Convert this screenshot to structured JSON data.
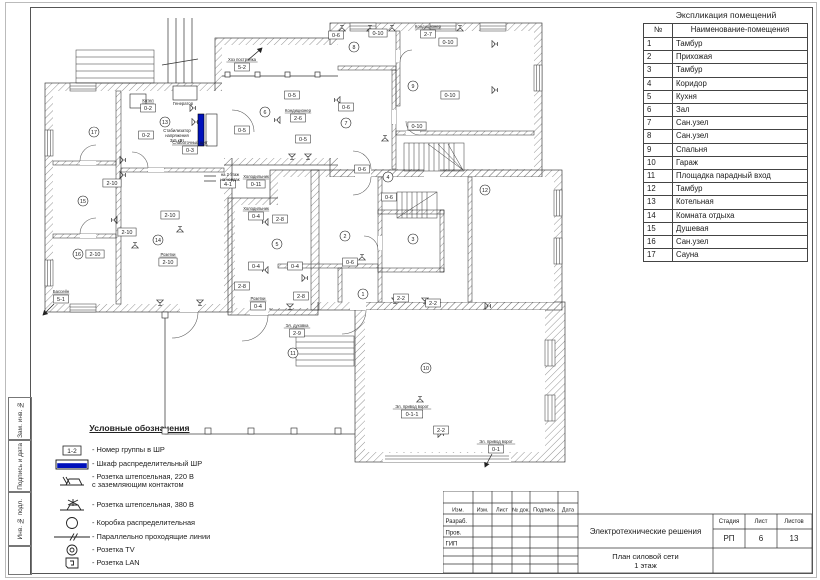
{
  "sheet": {
    "side_labels": [
      "Зам. инв. №",
      "Подпись и дата",
      "Инв. № подл."
    ]
  },
  "explication": {
    "title": "Экспликация помещений",
    "col_num": "№",
    "col_name": "Наименование-помещения",
    "rows": [
      {
        "n": "1",
        "name": "Тамбур"
      },
      {
        "n": "2",
        "name": "Прихожая"
      },
      {
        "n": "3",
        "name": "Тамбур"
      },
      {
        "n": "4",
        "name": "Коридор"
      },
      {
        "n": "5",
        "name": "Кухня"
      },
      {
        "n": "6",
        "name": "Зал"
      },
      {
        "n": "7",
        "name": "Сан.узел"
      },
      {
        "n": "8",
        "name": "Сан.узел"
      },
      {
        "n": "9",
        "name": "Спальня"
      },
      {
        "n": "10",
        "name": "Гараж"
      },
      {
        "n": "11",
        "name": "Площадка парадный вход"
      },
      {
        "n": "12",
        "name": "Тамбур"
      },
      {
        "n": "13",
        "name": "Котельная"
      },
      {
        "n": "14",
        "name": "Комната отдыха"
      },
      {
        "n": "15",
        "name": "Душевая"
      },
      {
        "n": "16",
        "name": "Сан.узел"
      },
      {
        "n": "17",
        "name": "Сауна"
      }
    ]
  },
  "legend": {
    "title": "Условные обозначения",
    "items": [
      {
        "key": "group-box",
        "symbol_text": "1-2",
        "label": "- Номер  группы в ШР"
      },
      {
        "key": "cabinet",
        "label": "- Шкаф распределительный ШР"
      },
      {
        "key": "socket-220",
        "label": "- Розетка штепсельная,  220 В\nс заземляющим контактом"
      },
      {
        "key": "socket-380",
        "label": "- Розетка штепсельная, 380 В"
      },
      {
        "key": "junction-box",
        "label": "- Коробка распределительная"
      },
      {
        "key": "parallel-lines",
        "label": "- Параллельно проходящие линии"
      },
      {
        "key": "tv",
        "label": "- Розетка TV"
      },
      {
        "key": "lan",
        "label": "- Розетка LAN"
      }
    ]
  },
  "titleblock": {
    "cols": [
      "Изм.",
      "Изм.",
      "Лист",
      "№ док.",
      "Подпись",
      "Дата"
    ],
    "rows": [
      "Разраб.",
      "Пров.",
      "ГИП"
    ],
    "project_title": "Электротехнические решения",
    "sheet_title_1": "План силовой сети",
    "sheet_title_2": "1 этаж",
    "stage_label": "Стадия",
    "sheet_label": "Лист",
    "sheets_label": "Листов",
    "stage": "РП",
    "sheet": "6",
    "sheets": "13"
  },
  "colors": {
    "cabinet_blue": "#0011bb",
    "line": "#1a1a1a"
  },
  "plan": {
    "rooms": [
      {
        "n": "1",
        "x": 323,
        "y": 284
      },
      {
        "n": "2",
        "x": 305,
        "y": 226
      },
      {
        "n": "3",
        "x": 373,
        "y": 229
      },
      {
        "n": "4",
        "x": 348,
        "y": 167
      },
      {
        "n": "5",
        "x": 237,
        "y": 234
      },
      {
        "n": "6",
        "x": 225,
        "y": 102
      },
      {
        "n": "7",
        "x": 306,
        "y": 113
      },
      {
        "n": "8",
        "x": 314,
        "y": 37
      },
      {
        "n": "9",
        "x": 373,
        "y": 76
      },
      {
        "n": "10",
        "x": 386,
        "y": 358
      },
      {
        "n": "11",
        "x": 253,
        "y": 343
      },
      {
        "n": "12",
        "x": 445,
        "y": 180
      },
      {
        "n": "13",
        "x": 125,
        "y": 112
      },
      {
        "n": "14",
        "x": 118,
        "y": 230
      },
      {
        "n": "15",
        "x": 43,
        "y": 191
      },
      {
        "n": "16",
        "x": 38,
        "y": 244
      },
      {
        "n": "17",
        "x": 54,
        "y": 122
      }
    ],
    "labels": [
      {
        "t": "5-2",
        "x": 202,
        "y": 57,
        "cap": "Хоз постройка"
      },
      {
        "t": "0-6",
        "x": 296,
        "y": 25
      },
      {
        "t": "0-10",
        "x": 338,
        "y": 23
      },
      {
        "t": "2-7",
        "x": 388,
        "y": 24,
        "cap": "Кондиционер"
      },
      {
        "t": "0-10",
        "x": 408,
        "y": 32
      },
      {
        "t": "0-10",
        "x": 410,
        "y": 85
      },
      {
        "t": "0-6",
        "x": 306,
        "y": 97
      },
      {
        "t": "0-10",
        "x": 377,
        "y": 116
      },
      {
        "t": "0-5",
        "x": 252,
        "y": 85
      },
      {
        "t": "0-5",
        "x": 202,
        "y": 120
      },
      {
        "t": "0-5",
        "x": 263,
        "y": 129
      },
      {
        "t": "2-6",
        "x": 258,
        "y": 108,
        "cap": "Кондиционер"
      },
      {
        "t": "0-2",
        "x": 108,
        "y": 98,
        "cap": "Котел"
      },
      {
        "t": "0-2",
        "x": 106,
        "y": 125
      },
      {
        "t": "0-3",
        "x": 150,
        "y": 140,
        "cap": "Слаботочный щит"
      },
      {
        "t": "0-11",
        "x": 216,
        "y": 174,
        "cap": "Холодильник"
      },
      {
        "t": "4-1",
        "x": 188,
        "y": 174
      },
      {
        "t": "2-10",
        "x": 72,
        "y": 173
      },
      {
        "t": "2-10",
        "x": 87,
        "y": 222
      },
      {
        "t": "2-10",
        "x": 55,
        "y": 244
      },
      {
        "t": "2-10",
        "x": 130,
        "y": 205
      },
      {
        "t": "2-10",
        "x": 128,
        "y": 252,
        "cap": "Розетки"
      },
      {
        "t": "5-1",
        "x": 21,
        "y": 289,
        "cap": "Бассейн"
      },
      {
        "t": "0-4",
        "x": 216,
        "y": 206,
        "cap": "Холодильник"
      },
      {
        "t": "2-8",
        "x": 240,
        "y": 209
      },
      {
        "t": "0-4",
        "x": 216,
        "y": 256
      },
      {
        "t": "0-4",
        "x": 255,
        "y": 256
      },
      {
        "t": "2-8",
        "x": 202,
        "y": 276
      },
      {
        "t": "2-8",
        "x": 261,
        "y": 286
      },
      {
        "t": "0-4",
        "x": 218,
        "y": 296,
        "cap": "Розетки"
      },
      {
        "t": "2-9",
        "x": 257,
        "y": 323,
        "cap": "Эл. духовка"
      },
      {
        "t": "0-6",
        "x": 322,
        "y": 159
      },
      {
        "t": "0-6",
        "x": 349,
        "y": 187
      },
      {
        "t": "0-6",
        "x": 310,
        "y": 252
      },
      {
        "t": "2-2",
        "x": 361,
        "y": 288
      },
      {
        "t": "2-2",
        "x": 393,
        "y": 293
      },
      {
        "t": "0-1-1",
        "x": 372,
        "y": 404,
        "cap": "Эл. привод ворот"
      },
      {
        "t": "2-2",
        "x": 401,
        "y": 420
      },
      {
        "t": "0-1",
        "x": 456,
        "y": 439,
        "cap": "Эл. привод ворот"
      }
    ],
    "captions": [
      {
        "t": "Генератор",
        "x": 143,
        "y": 95
      },
      {
        "t": "Стабилизатор",
        "x": 137,
        "y": 122
      },
      {
        "t": "напряжения",
        "x": 137,
        "y": 127
      },
      {
        "t": "3х5 кВт",
        "x": 137,
        "y": 132
      },
      {
        "t": "на 2 этаж",
        "x": 190,
        "y": 166
      },
      {
        "t": "на чердак",
        "x": 190,
        "y": 171
      }
    ],
    "sockets": [
      {
        "x": 302,
        "y": 21,
        "r": 0
      },
      {
        "x": 330,
        "y": 21,
        "r": 0
      },
      {
        "x": 352,
        "y": 21,
        "r": 0
      },
      {
        "x": 420,
        "y": 21,
        "r": 0
      },
      {
        "x": 452,
        "y": 34,
        "r": 90
      },
      {
        "x": 452,
        "y": 80,
        "r": 90
      },
      {
        "x": 300,
        "y": 90,
        "r": 270
      },
      {
        "x": 345,
        "y": 131,
        "r": 0
      },
      {
        "x": 240,
        "y": 110,
        "r": 270
      },
      {
        "x": 252,
        "y": 144,
        "r": 180
      },
      {
        "x": 268,
        "y": 144,
        "r": 180
      },
      {
        "x": 150,
        "y": 98,
        "r": 90
      },
      {
        "x": 152,
        "y": 112,
        "r": 90
      },
      {
        "x": 80,
        "y": 150,
        "r": 90
      },
      {
        "x": 80,
        "y": 165,
        "r": 90
      },
      {
        "x": 77,
        "y": 210,
        "r": 270
      },
      {
        "x": 95,
        "y": 238,
        "r": 0
      },
      {
        "x": 140,
        "y": 222,
        "r": 0
      },
      {
        "x": 120,
        "y": 290,
        "r": 180
      },
      {
        "x": 160,
        "y": 290,
        "r": 180
      },
      {
        "x": 228,
        "y": 212,
        "r": 270
      },
      {
        "x": 228,
        "y": 260,
        "r": 270
      },
      {
        "x": 262,
        "y": 268,
        "r": 90
      },
      {
        "x": 250,
        "y": 294,
        "r": 180
      },
      {
        "x": 322,
        "y": 250,
        "r": 0
      },
      {
        "x": 355,
        "y": 288,
        "r": 180
      },
      {
        "x": 385,
        "y": 288,
        "r": 180
      },
      {
        "x": 380,
        "y": 392,
        "r": 0
      },
      {
        "x": 398,
        "y": 424,
        "r": 90
      },
      {
        "x": 445,
        "y": 296,
        "r": 90
      }
    ]
  }
}
